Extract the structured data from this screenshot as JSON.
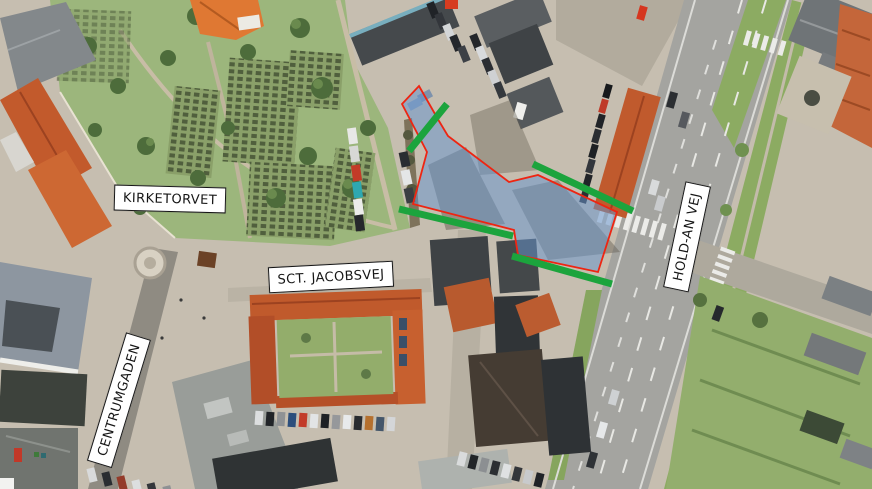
{
  "labels": {
    "kirketorvet": {
      "text": "KIRKETORVET",
      "x": 170,
      "y": 199,
      "rotation": 1.5
    },
    "sct_jacobsvej": {
      "text": "SCT. JACOBSVEJ",
      "x": 331,
      "y": 277,
      "rotation": -3
    },
    "centrumgaden": {
      "text": "CENTRUMGADEN",
      "x": 119,
      "y": 400,
      "rotation": -73
    },
    "hold_an_vej": {
      "text": "HOLD-AN VEJ",
      "x": 687,
      "y": 237,
      "rotation": -78
    }
  },
  "annotations": {
    "highlight_area": {
      "description": "project area highlighted on aerial photo",
      "fill": "#6593cd",
      "fill_opacity": 0.52,
      "stroke": "#ee2512",
      "stroke_width": 1.8,
      "points": [
        [
          419,
          86
        ],
        [
          439,
          121
        ],
        [
          448,
          136
        ],
        [
          509,
          182
        ],
        [
          538,
          175
        ],
        [
          617,
          212
        ],
        [
          612,
          228
        ],
        [
          598,
          272
        ],
        [
          518,
          255
        ],
        [
          514,
          230
        ],
        [
          413,
          204
        ],
        [
          427,
          152
        ],
        [
          402,
          104
        ]
      ]
    },
    "green_markers": {
      "color": "#1ca43d",
      "width": 7,
      "lines": [
        [
          447,
          104,
          409,
          151
        ],
        [
          533,
          164,
          633,
          211
        ],
        [
          399,
          209,
          513,
          236
        ],
        [
          512,
          256,
          612,
          284
        ]
      ]
    }
  }
}
